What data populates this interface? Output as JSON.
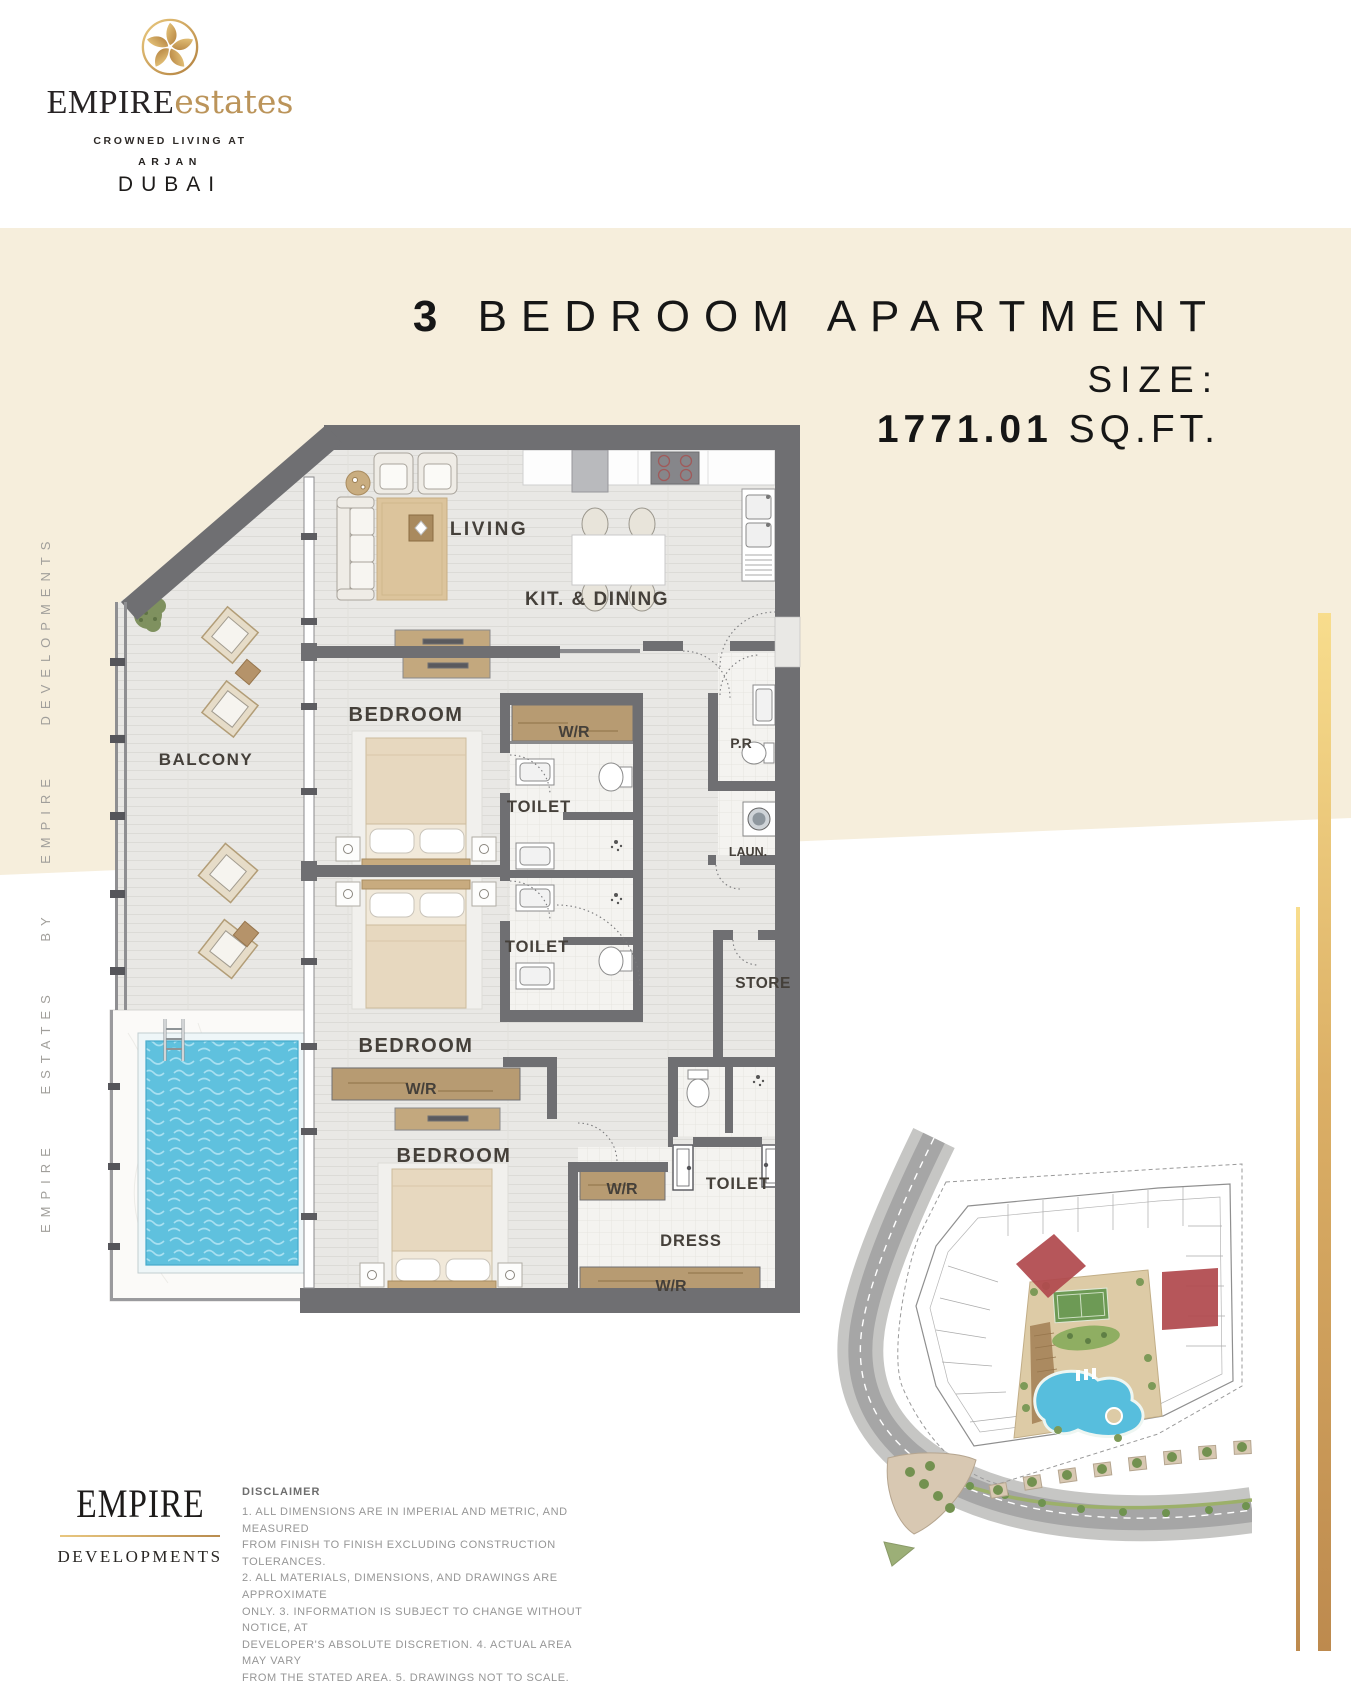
{
  "brand": {
    "name_primary": "EMPIRE",
    "name_secondary": "estates",
    "tagline": "CROWNED LIVING AT",
    "location_area": "ARJAN",
    "location_city": "DUBAI"
  },
  "title": {
    "number": "3",
    "text": "BEDROOM APARTMENT",
    "size_label": "SIZE:",
    "size_value": "1771.01",
    "size_unit": "SQ.FT."
  },
  "side_text": "EMPIRE ESTATES BY EMPIRE DEVELOPMENTS",
  "floor_plan": {
    "rooms": {
      "living": "LIVING",
      "kit_dining": "KIT. & DINING",
      "bedroom": "BEDROOM",
      "balcony": "BALCONY",
      "wardrobe": "W/R",
      "toilet": "TOILET",
      "powder_room": "P.R",
      "laundry": "LAUN.",
      "store": "STORE",
      "dress": "DRESS"
    }
  },
  "footer": {
    "logo_primary": "EMPIRE",
    "logo_secondary": "DEVELOPMENTS",
    "disclaimer_title": "DISCLAIMER",
    "disclaimer_lines": [
      "1. ALL DIMENSIONS ARE IN IMPERIAL AND METRIC, AND MEASURED",
      "FROM FINISH TO FINISH EXCLUDING CONSTRUCTION TOLERANCES.",
      "2. ALL MATERIALS, DIMENSIONS, AND DRAWINGS ARE APPROXIMATE",
      "ONLY. 3. INFORMATION IS SUBJECT TO CHANGE WITHOUT NOTICE, AT",
      "DEVELOPER'S ABSOLUTE DISCRETION. 4. ACTUAL AREA MAY VARY",
      "FROM THE STATED AREA. 5. DRAWINGS NOT TO SCALE."
    ]
  },
  "colors": {
    "cream": "#f6eedc",
    "wall_gray": "#6f6f72",
    "gold_light": "#f5d98b",
    "gold_dark": "#bd8a4e",
    "accent_red": "#b0494d",
    "pool_blue": "#5fc1de",
    "wood_tan": "#b79b72"
  }
}
